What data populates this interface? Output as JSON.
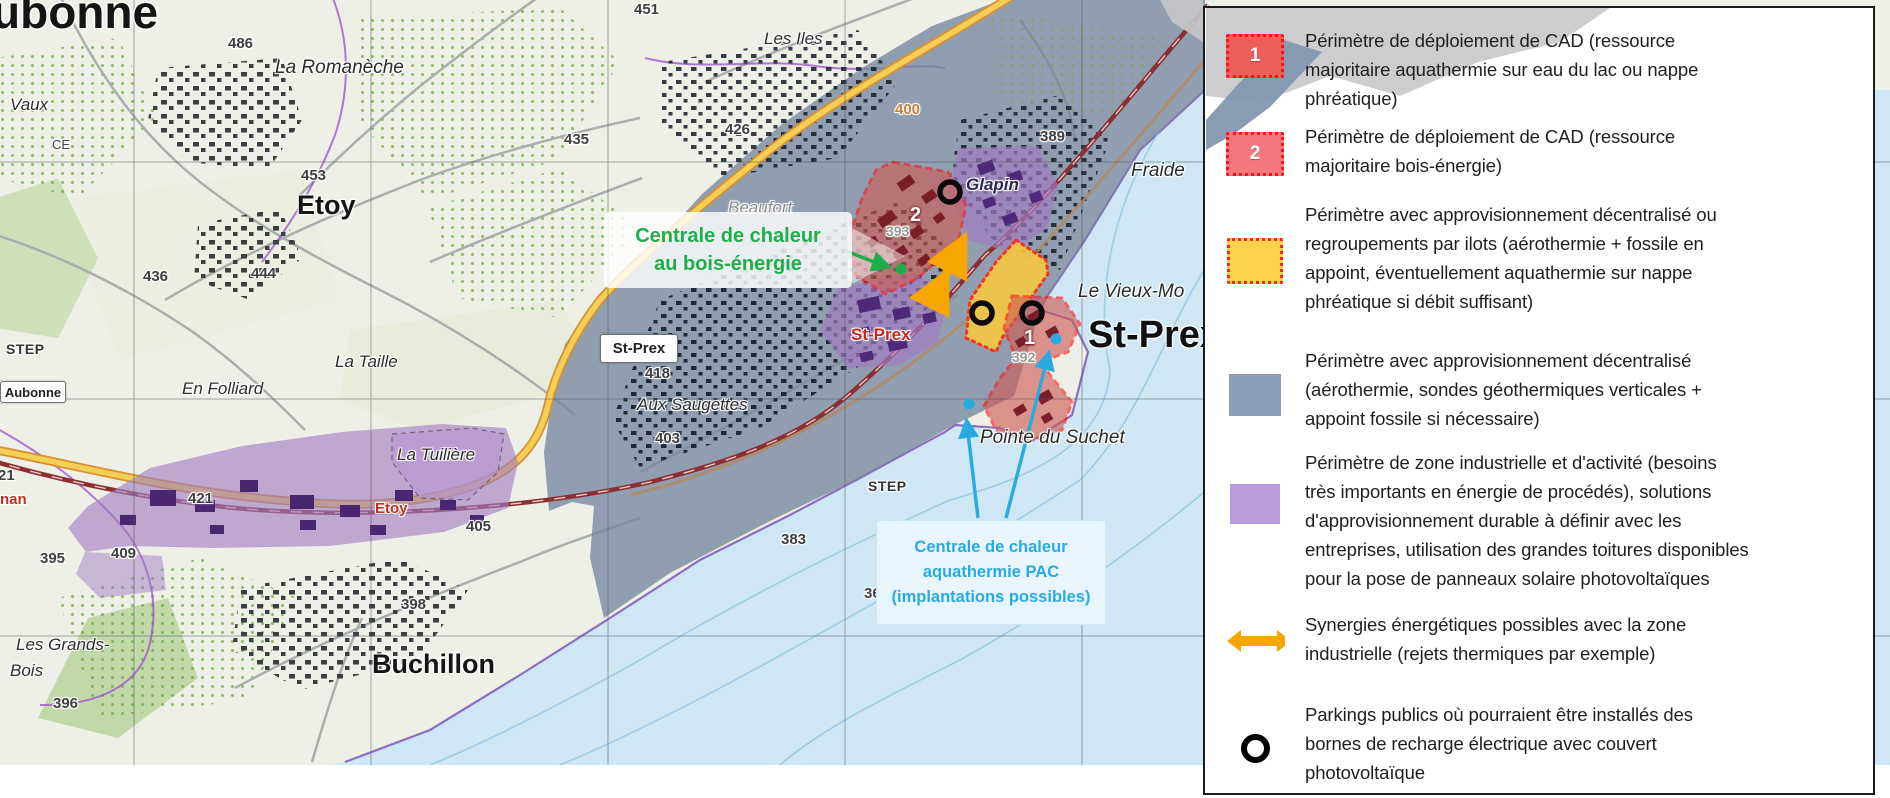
{
  "map": {
    "labels": [
      {
        "text": "ubonne",
        "x": -8,
        "y": -12,
        "cls": "c-huge",
        "name": "label-aubonne-town"
      },
      {
        "text": "Vaux",
        "x": 10,
        "y": 96,
        "cls": "c-loc",
        "name": "label-vaux"
      },
      {
        "text": "CE",
        "x": 52,
        "y": 138,
        "cls": "c-elev-sm",
        "name": "label-ce"
      },
      {
        "text": "486",
        "x": 228,
        "y": 36,
        "cls": "c-elev",
        "name": "label-486"
      },
      {
        "text": "La Romanèche",
        "x": 275,
        "y": 58,
        "cls": "c-loc-lg",
        "name": "label-la-romaneche"
      },
      {
        "text": "451",
        "x": 634,
        "y": 2,
        "cls": "c-elev",
        "name": "label-451"
      },
      {
        "text": "Les Iles",
        "x": 764,
        "y": 30,
        "cls": "c-loc",
        "name": "label-les-iles"
      },
      {
        "text": "426",
        "x": 725,
        "y": 122,
        "cls": "c-elev",
        "name": "label-426"
      },
      {
        "text": "435",
        "x": 564,
        "y": 132,
        "cls": "c-elev",
        "name": "label-435"
      },
      {
        "text": "453",
        "x": 301,
        "y": 168,
        "cls": "c-elev",
        "name": "label-453"
      },
      {
        "text": "Etoy",
        "x": 297,
        "y": 191,
        "cls": "c-town",
        "name": "label-etoy-town"
      },
      {
        "text": "444",
        "x": 251,
        "y": 266,
        "cls": "c-elev",
        "name": "label-444"
      },
      {
        "text": "436",
        "x": 143,
        "y": 269,
        "cls": "c-elev",
        "name": "label-436"
      },
      {
        "text": "STEP",
        "x": 6,
        "y": 342,
        "cls": "c-step",
        "name": "label-step-west"
      },
      {
        "text": "La Taille",
        "x": 335,
        "y": 353,
        "cls": "c-loc",
        "name": "label-la-taille"
      },
      {
        "text": "En Folliard",
        "x": 182,
        "y": 380,
        "cls": "c-loc",
        "name": "label-en-folliard"
      },
      {
        "text": "421",
        "x": 188,
        "y": 491,
        "cls": "c-elev",
        "name": "label-421"
      },
      {
        "text": "395",
        "x": 40,
        "y": 551,
        "cls": "c-elev",
        "name": "label-395"
      },
      {
        "text": "409",
        "x": 111,
        "y": 546,
        "cls": "c-elev",
        "name": "label-409"
      },
      {
        "text": "21",
        "x": -2,
        "y": 468,
        "cls": "c-elev",
        "name": "label-21"
      },
      {
        "text": "nan",
        "x": 0,
        "y": 492,
        "cls": "c-red",
        "name": "label-allaman"
      },
      {
        "text": "Etoy",
        "x": 375,
        "y": 501,
        "cls": "c-red",
        "name": "label-etoy-road"
      },
      {
        "text": "405",
        "x": 466,
        "y": 519,
        "cls": "c-elev",
        "name": "label-405"
      },
      {
        "text": "La Tuilière",
        "x": 397,
        "y": 446,
        "cls": "c-loc",
        "name": "label-la-tuiliere"
      },
      {
        "text": "398",
        "x": 401,
        "y": 597,
        "cls": "c-elev",
        "name": "label-398"
      },
      {
        "text": "Les Grands-",
        "x": 16,
        "y": 636,
        "cls": "c-loc",
        "name": "label-les-grands"
      },
      {
        "text": "Bois",
        "x": 10,
        "y": 662,
        "cls": "c-loc",
        "name": "label-bois"
      },
      {
        "text": "396",
        "x": 53,
        "y": 696,
        "cls": "c-elev",
        "name": "label-396"
      },
      {
        "text": "Buchillon",
        "x": 372,
        "y": 650,
        "cls": "c-town",
        "name": "label-buchillon-town"
      },
      {
        "text": "418",
        "x": 645,
        "y": 366,
        "cls": "c-elev",
        "name": "label-418"
      },
      {
        "text": "Aux Saugettes",
        "x": 637,
        "y": 396,
        "cls": "c-loc",
        "name": "label-aux-saugettes"
      },
      {
        "text": "403",
        "x": 655,
        "y": 431,
        "cls": "c-elev",
        "name": "label-403"
      },
      {
        "text": "383",
        "x": 781,
        "y": 532,
        "cls": "c-elev",
        "name": "label-383"
      },
      {
        "text": "STEP",
        "x": 868,
        "y": 479,
        "cls": "c-step",
        "name": "label-step-east"
      },
      {
        "text": "36",
        "x": 864,
        "y": 586,
        "cls": "c-elev",
        "name": "label-36"
      },
      {
        "text": "Beaufort",
        "x": 728,
        "y": 199,
        "cls": "c-loc c-gray",
        "name": "label-beaufort"
      },
      {
        "text": "Glapin",
        "x": 966,
        "y": 176,
        "cls": "c-glapin",
        "name": "label-glapin"
      },
      {
        "text": "400",
        "x": 895,
        "y": 102,
        "cls": "c-orange",
        "name": "label-400"
      },
      {
        "text": "389",
        "x": 1040,
        "y": 129,
        "cls": "c-elev",
        "name": "label-389"
      },
      {
        "text": "393",
        "x": 886,
        "y": 224,
        "cls": "c-graynum",
        "name": "label-393"
      },
      {
        "text": "392",
        "x": 1012,
        "y": 350,
        "cls": "c-graynum",
        "name": "label-392"
      },
      {
        "text": "Fraide",
        "x": 1131,
        "y": 161,
        "cls": "c-loc-lg",
        "name": "label-fraide"
      },
      {
        "text": "Le Vieux-Mo",
        "x": 1078,
        "y": 282,
        "cls": "c-loc-lg",
        "name": "label-le-vieux-moulin"
      },
      {
        "text": "St-Prex",
        "x": 1088,
        "y": 316,
        "cls": "c-town-xl",
        "name": "label-st-prex-town"
      },
      {
        "text": "St-Prex",
        "x": 851,
        "y": 326,
        "cls": "c-redplace",
        "name": "label-st-prex-red"
      },
      {
        "text": "Pointe du Suchet",
        "x": 980,
        "y": 428,
        "cls": "c-loc-lg",
        "name": "label-pointe-du-suchet"
      },
      {
        "text": "2",
        "x": 910,
        "y": 205,
        "cls": "c-zone-num",
        "name": "zone-2-number"
      },
      {
        "text": "1",
        "x": 1024,
        "y": 328,
        "cls": "c-zone-num",
        "name": "zone-1-number"
      }
    ],
    "signs": [
      {
        "text": "St-Prex",
        "x": 600,
        "y": 334,
        "w": 76,
        "h": 27,
        "fs": 15,
        "name": "sign-st-prex"
      },
      {
        "text": "Aubonne",
        "x": 0,
        "y": 381,
        "w": 64,
        "h": 20,
        "fs": 13,
        "name": "sign-aubonne"
      }
    ],
    "green_label": {
      "text": "Centrale de chaleur\nau bois-énergie"
    },
    "cyan_label": {
      "text": "Centrale de chaleur\naquathermie PAC\n(implantations possibles)"
    }
  },
  "legend": {
    "items": [
      {
        "swatch": "red",
        "num": "1",
        "label": "Périmètre de déploiement de CAD (ressource\nmajoritaire aquathermie sur eau du lac ou nappe\nphréatique)"
      },
      {
        "swatch": "red2",
        "num": "2",
        "label": "Périmètre de déploiement de CAD (ressource\nmajoritaire bois-énergie)"
      },
      {
        "swatch": "yellow",
        "num": "",
        "label": "Périmètre avec approvisionnement décentralisé ou\nregroupements par ilots (aérothermie + fossile en\nappoint, éventuellement aquathermie sur nappe\nphréatique si débit suffisant)"
      },
      {
        "swatch": "slate",
        "num": "",
        "label": "Périmètre avec approvisionnement décentralisé\n(aérothermie, sondes géothermiques verticales +\nappoint fossile si nécessaire)"
      },
      {
        "swatch": "purple",
        "num": "",
        "label": "Périmètre de zone industrielle et d'activité (besoins\ntrès importants en énergie de procédés), solutions\nd'approvisionnement durable à définir avec les\nentreprises, utilisation des grandes toitures disponibles\npour la pose de panneaux solaire photovoltaïques"
      },
      {
        "swatch": "arrow",
        "num": "",
        "label": "Synergies énergétiques possibles avec la zone\nindustrielle (rejets thermiques par exemple)"
      },
      {
        "swatch": "circle",
        "num": "",
        "label": "Parkings publics où pourraient être installés des\nbornes de recharge électrique avec couvert\nphotovoltaïque"
      }
    ]
  },
  "colors": {
    "cad_red": "#ee5f5b",
    "cad_red2": "#f4797e",
    "dash_red": "#ff1111",
    "zone_yellow": "#fbd24b",
    "zone_slate": "#8d9db7",
    "zone_purple": "#b69dd8",
    "synergy_orange": "#f7a600",
    "green_accent": "#1fae4b",
    "cyan_accent": "#29abe2",
    "lake_blue": "#cfe7f4"
  }
}
